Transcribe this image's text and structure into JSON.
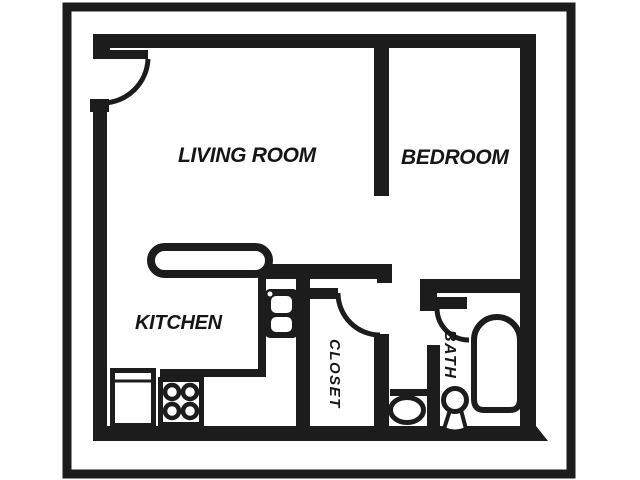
{
  "meta": {
    "title": "Studio apartment floor plan",
    "style": "scanned black-and-white line drawing inside a rectangular frame"
  },
  "colors": {
    "ink": "#1c1c1c",
    "paper": "#ffffff"
  },
  "rooms": [
    {
      "id": "living_room",
      "label": "LIVING ROOM"
    },
    {
      "id": "bedroom",
      "label": "BEDROOM"
    },
    {
      "id": "kitchen",
      "label": "KITCHEN"
    },
    {
      "id": "closet",
      "label": "CLOSET"
    },
    {
      "id": "bath",
      "label": "BATH"
    }
  ],
  "fixtures": {
    "doors": [
      "entry-door",
      "closet-door",
      "bath-door"
    ],
    "kitchen": [
      "counter-peninsula",
      "kitchen-sink",
      "refrigerator",
      "stove-four-burners"
    ],
    "bath": [
      "toilet",
      "pedestal-sink",
      "bathtub"
    ]
  }
}
